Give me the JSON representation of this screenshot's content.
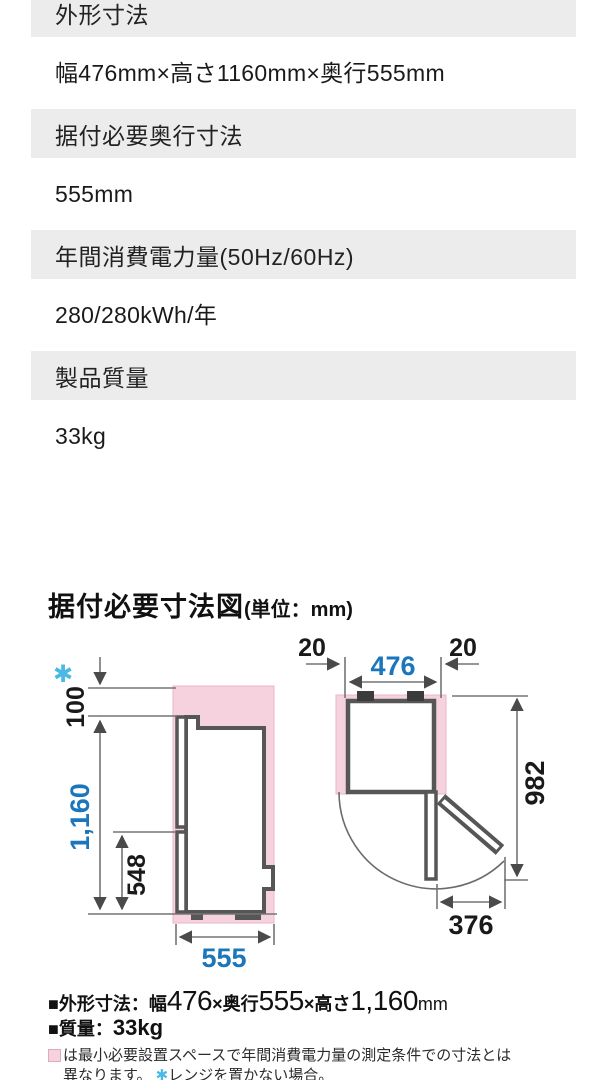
{
  "colors": {
    "band_gray": "#ececec",
    "dim_blue": "#1b76bb",
    "asterisk_cyan": "#4cb8e4",
    "clearance_pink": "#f6d1de",
    "outline_gray": "#565656"
  },
  "spec_table": {
    "rows": [
      {
        "label": "外形寸法",
        "value": "幅476mm×高さ1160mm×奥行555mm"
      },
      {
        "label": "据付必要奥行寸法",
        "value": "555mm"
      },
      {
        "label": "年間消費電力量(50Hz/60Hz)",
        "value": "280/280kWh/年"
      },
      {
        "label": "製品質量",
        "value": "33kg"
      }
    ]
  },
  "diagram": {
    "title": "据付必要寸法図",
    "title_unit": "(単位：mm)",
    "side_view": {
      "asterisk": "✱",
      "top_clearance": "100",
      "total_height": "1,160",
      "lower_section": "548",
      "depth": "555"
    },
    "top_view": {
      "left_clearance": "20",
      "right_clearance": "20",
      "width": "476",
      "open_depth": "982",
      "door_swing": "376"
    }
  },
  "footer": {
    "dims": {
      "label": "■外形寸法：幅",
      "width": "476",
      "sep1": "×奥行",
      "depth": "555",
      "sep2": "×高さ",
      "height": "1,160",
      "unit": "mm"
    },
    "weight": {
      "label": "■質量：",
      "value": "33kg"
    },
    "note_line1": "は最小必要設置スペースで年間消費電力量の測定条件での寸法とは",
    "note_line2_pre": "異なります。 ",
    "note_asterisk": "✱",
    "note_line2_post": "レンジを置かない場合。"
  }
}
